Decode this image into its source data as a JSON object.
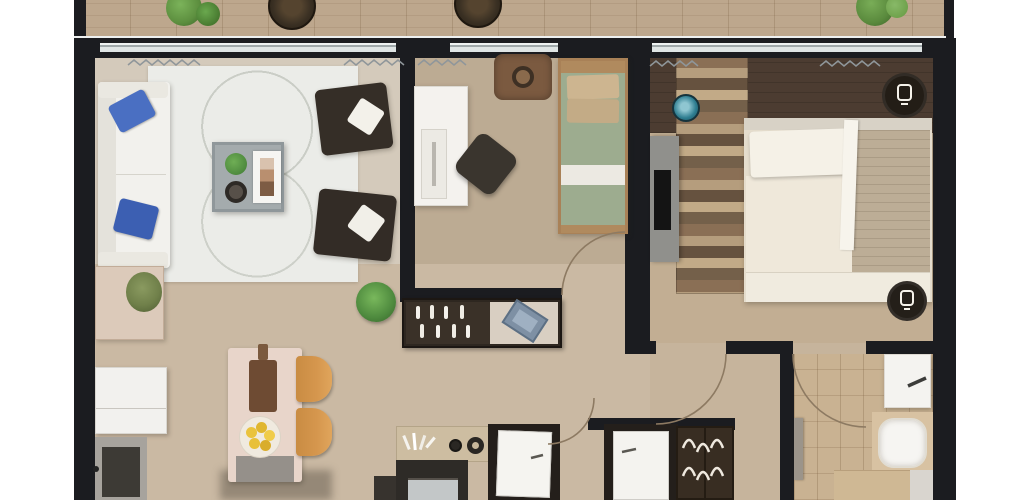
{
  "scene": {
    "type": "3d-floor-plan-top-view",
    "description": "Photorealistic top-down 3D render of a two-bedroom apartment with balcony, open living/dining/kitchen area, office bedroom, master bedroom, hallway and bathroom. No text labels are visible in the image."
  },
  "palette": {
    "wall": "#1b1c20",
    "balcony_floor": "#bda78d",
    "living_floor": "#d4cabb",
    "dining_floor": "#cab9a3",
    "office_floor": "#bcab93",
    "master_floor": "#c2ae93",
    "master_accent_band": "#4c3c31",
    "hall_floor": "#c6b49c",
    "bath_floor": "#c9b292",
    "rug": "#ebece8",
    "sofa_white": "#f2f1ed",
    "pillow_blue": "#4a6fc2",
    "armchair_brown": "#352e27",
    "island_pink": "#e8d5ca",
    "stool_tan": "#d6974e",
    "bed_green": "#9dac8f",
    "bed_white": "#ece4d5",
    "teal_accent": "#2e7d90",
    "plant_green": "#5d8f3f",
    "fruit_yellow": "#eac33e",
    "glass": "#dfe5e5",
    "arc_line": "#8d7a62"
  },
  "rooms": {
    "balcony": {
      "items": [
        "potted-plant",
        "round-wicker-chair",
        "round-wicker-chair",
        "potted-plant"
      ]
    },
    "living_room": {
      "items": [
        "white-sofa",
        "blue-pillow",
        "blue-pillow",
        "area-rug",
        "coffee-table",
        "houseplant",
        "decor-bowl",
        "magazine",
        "dark-armchair",
        "dark-armchair",
        "sideboard-with-plant",
        "floor-plant"
      ]
    },
    "office_bedroom": {
      "items": [
        "white-desk",
        "office-chair",
        "pet-bed-pouf",
        "single-bed-green"
      ]
    },
    "master_bedroom": {
      "items": [
        "tv-console",
        "tv",
        "teal-stool",
        "rustic-wood-runner",
        "double-bed",
        "white-pillows",
        "beige-throw",
        "ceiling-lamp",
        "ceiling-lamp"
      ]
    },
    "kitchen_dining": {
      "items": [
        "kitchen-island",
        "cutting-board",
        "fruit-bowl",
        "bar-stool",
        "bar-stool",
        "fridge",
        "entry-unit",
        "counter-with-cooktop",
        "oven",
        "console-shelf-with-bottles",
        "tray",
        "potted-plant"
      ]
    },
    "hallway": {
      "items": [
        "interior-door",
        "interior-door",
        "wardrobe-with-hangers",
        "door-swing-arc",
        "door-swing-arc",
        "door-swing-arc",
        "door-swing-arc"
      ]
    },
    "bathroom": {
      "items": [
        "vanity-sink",
        "faucet",
        "bathtub",
        "bottom-cabinet",
        "towel-rail"
      ]
    }
  }
}
